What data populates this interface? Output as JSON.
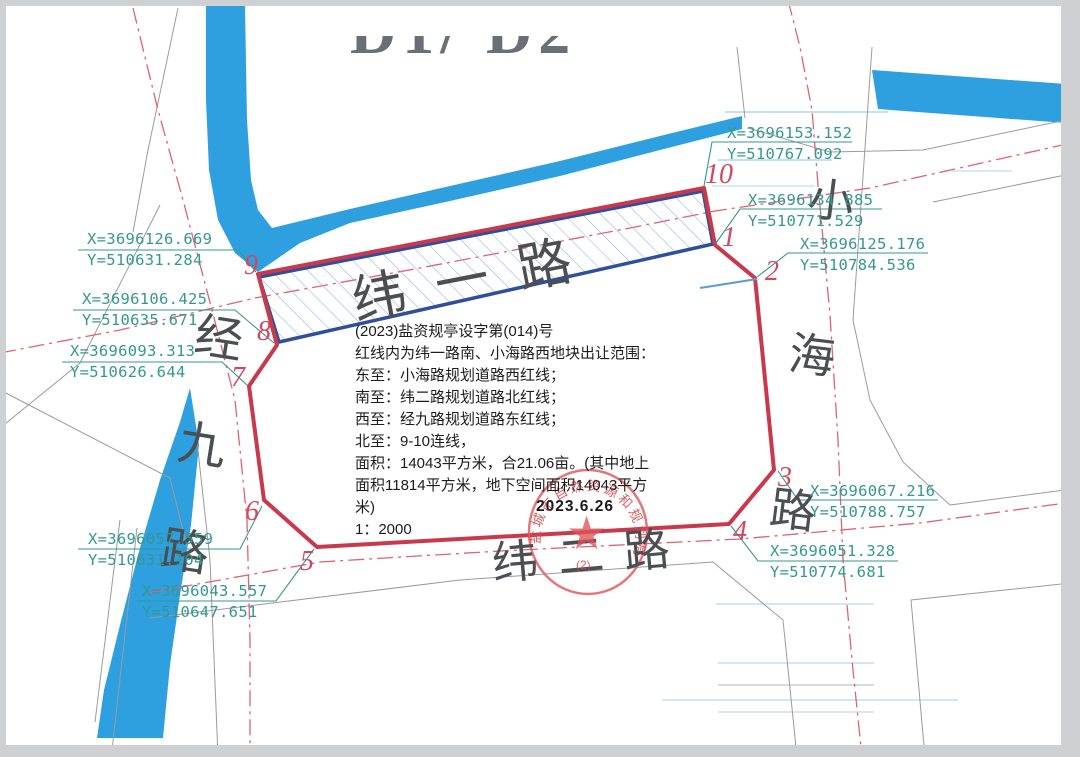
{
  "header": {
    "title": "D1/ D2"
  },
  "notes": {
    "l1": "(2023)盐资规亭设字第(014)号",
    "l2": "红线内为纬一路南、小海路西地块出让范围：",
    "l3": "东至：小海路规划道路西红线；",
    "l4": "南至：纬二路规划道路北红线；",
    "l5": "西至：经九路规划道路东红线；",
    "l6": "北至：9-10连线，",
    "l7": "面积：14043平方米，合21.06亩。(其中地上",
    "l8": "面积11814平方米，地下空间面积14043平方",
    "l9": "米)",
    "l10": "1：2000"
  },
  "roads": {
    "weiyi": "纬一路",
    "jingjiu": "经九路",
    "xiaohai": "小海路",
    "weier": "纬二路"
  },
  "seal": {
    "arc_text": "盐城市自然资源和规划局",
    "sub_text": "(2)",
    "date": "2023.6.26"
  },
  "vertices": {
    "v1": "1",
    "v2": "2",
    "v3": "3",
    "v4": "4",
    "v5": "5",
    "v6": "6",
    "v7": "7",
    "v8": "8",
    "v9": "9",
    "v10": "10"
  },
  "points": {
    "p1": {
      "x": "X=3696134.885",
      "y": "Y=510771.529"
    },
    "p2": {
      "x": "X=3696125.176",
      "y": "Y=510784.536"
    },
    "p3": {
      "x": "X=3696067.216",
      "y": "Y=510788.757"
    },
    "p4": {
      "x": "X=3696051.328",
      "y": "Y=510774.681"
    },
    "p5": {
      "x": "X=3696043.557",
      "y": "Y=510647.651"
    },
    "p6": {
      "x": "X=3696057.559",
      "y": "Y=510631.104"
    },
    "p7": {
      "x": "X=3696093.313",
      "y": "Y=510626.644"
    },
    "p8": {
      "x": "X=3696106.425",
      "y": "Y=510635.671"
    },
    "p9": {
      "x": "X=3696126.669",
      "y": "Y=510631.284"
    },
    "p10": {
      "x": "X=3696153.152",
      "y": "Y=510767.092"
    }
  },
  "colors": {
    "water": "#2E9FDF",
    "parcel_red": "#C9394B",
    "band_blue": "#2F4F9E",
    "coord_teal": "#35988F",
    "centerline_red": "#E06273"
  }
}
